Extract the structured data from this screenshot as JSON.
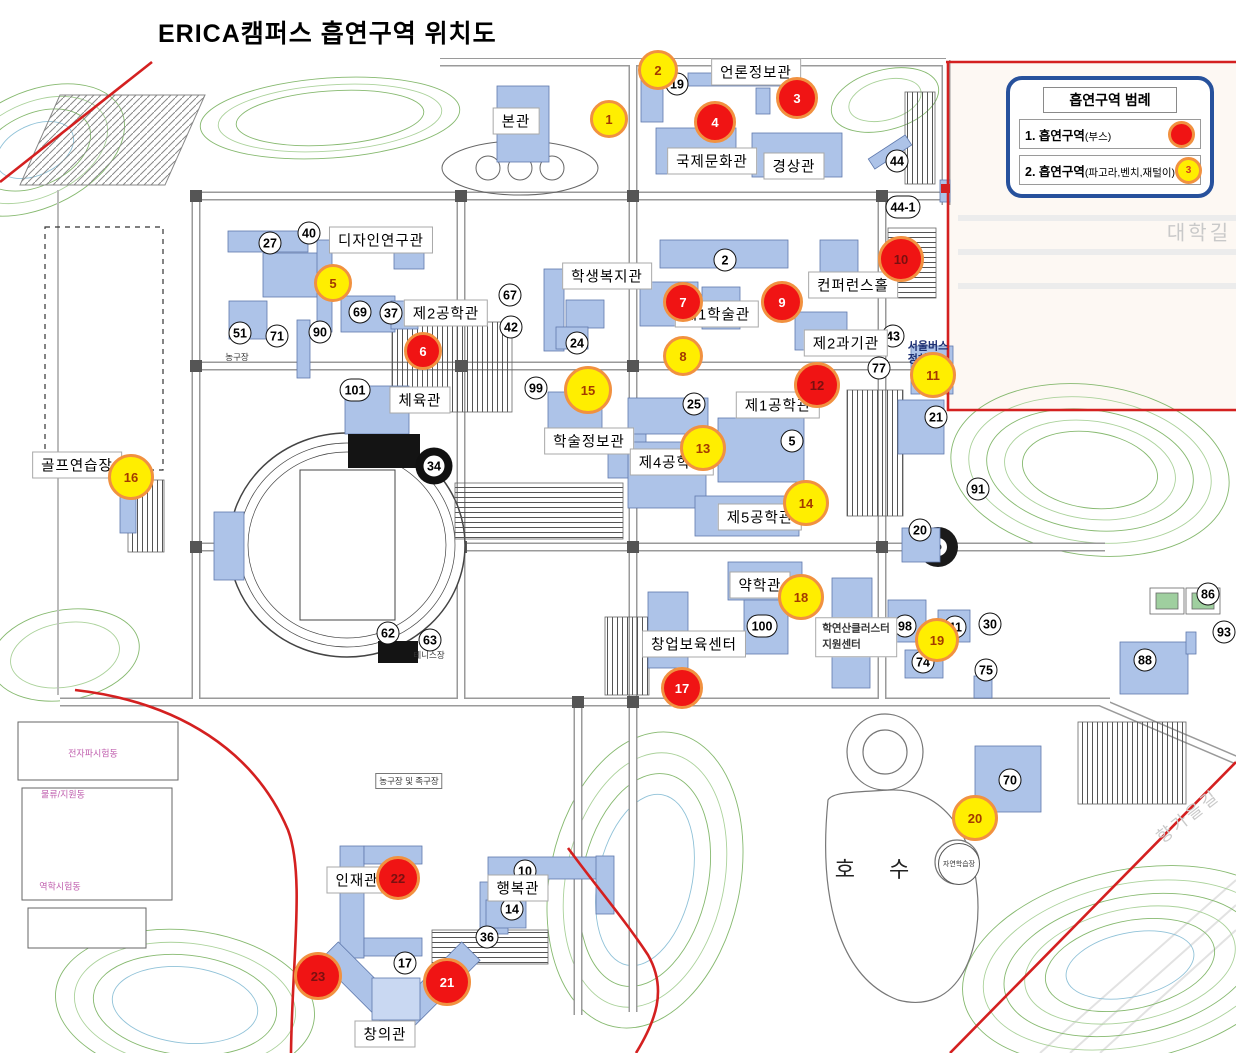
{
  "title": "ERICA캠퍼스 흡연구역 위치도",
  "legend": {
    "title": "흡연구역 범례",
    "items": [
      {
        "prefix": "1. 흡연구역",
        "paren": "(부스)",
        "type": "red",
        "sample": ""
      },
      {
        "prefix": "2. 흡연구역",
        "paren": "(파고라,벤치,재털이)",
        "type": "yellow",
        "sample": "3"
      }
    ]
  },
  "colors": {
    "booth_marker": "#f01414",
    "bench_marker": "#ffee00",
    "marker_ring": "#f19140",
    "legend_border": "#27519c",
    "building_fill": "#adc3e8",
    "boundary_line": "#d42020"
  },
  "markers": [
    {
      "n": "1",
      "type": "yellow",
      "x": 609,
      "y": 119,
      "d": 38
    },
    {
      "n": "2",
      "type": "yellow",
      "x": 658,
      "y": 70,
      "d": 40
    },
    {
      "n": "3",
      "type": "red",
      "x": 797,
      "y": 98,
      "d": 42
    },
    {
      "n": "4",
      "type": "red",
      "x": 715,
      "y": 122,
      "d": 42
    },
    {
      "n": "5",
      "type": "yellow",
      "x": 333,
      "y": 283,
      "d": 38
    },
    {
      "n": "6",
      "type": "red",
      "x": 423,
      "y": 351,
      "d": 38
    },
    {
      "n": "7",
      "type": "red",
      "x": 683,
      "y": 302,
      "d": 40
    },
    {
      "n": "8",
      "type": "yellow",
      "x": 683,
      "y": 356,
      "d": 40
    },
    {
      "n": "9",
      "type": "red",
      "x": 782,
      "y": 302,
      "d": 42
    },
    {
      "n": "10",
      "type": "red",
      "x": 901,
      "y": 259,
      "d": 46,
      "dark": true
    },
    {
      "n": "11",
      "type": "yellow",
      "x": 933,
      "y": 375,
      "d": 46
    },
    {
      "n": "12",
      "type": "red",
      "x": 817,
      "y": 385,
      "d": 46,
      "dark": true
    },
    {
      "n": "13",
      "type": "yellow",
      "x": 703,
      "y": 448,
      "d": 46
    },
    {
      "n": "14",
      "type": "yellow",
      "x": 806,
      "y": 503,
      "d": 46
    },
    {
      "n": "15",
      "type": "yellow",
      "x": 588,
      "y": 390,
      "d": 48
    },
    {
      "n": "16",
      "type": "yellow",
      "x": 131,
      "y": 477,
      "d": 46
    },
    {
      "n": "17",
      "type": "red",
      "x": 682,
      "y": 688,
      "d": 42
    },
    {
      "n": "18",
      "type": "yellow",
      "x": 801,
      "y": 597,
      "d": 46
    },
    {
      "n": "19",
      "type": "yellow",
      "x": 937,
      "y": 640,
      "d": 44
    },
    {
      "n": "20",
      "type": "yellow",
      "x": 975,
      "y": 818,
      "d": 46
    },
    {
      "n": "21",
      "type": "red",
      "x": 447,
      "y": 982,
      "d": 48
    },
    {
      "n": "22",
      "type": "red",
      "x": 398,
      "y": 878,
      "d": 44,
      "dark": true
    },
    {
      "n": "23",
      "type": "red",
      "x": 318,
      "y": 976,
      "d": 48,
      "dark": true
    }
  ],
  "building_labels": [
    {
      "text": "본관",
      "x": 516,
      "y": 121
    },
    {
      "text": "언론정보관",
      "x": 756,
      "y": 72
    },
    {
      "text": "국제문화관",
      "x": 712,
      "y": 161
    },
    {
      "text": "경상관",
      "x": 794,
      "y": 166
    },
    {
      "text": "디자인연구관",
      "x": 381,
      "y": 240
    },
    {
      "text": "제2공학관",
      "x": 446,
      "y": 313
    },
    {
      "text": "학생복지관",
      "x": 607,
      "y": 276
    },
    {
      "text": "제1학술관",
      "x": 717,
      "y": 314
    },
    {
      "text": "컨퍼런스홀",
      "x": 853,
      "y": 285
    },
    {
      "text": "제2과기관",
      "x": 846,
      "y": 343
    },
    {
      "text": "체육관",
      "x": 420,
      "y": 400
    },
    {
      "text": "학술정보관",
      "x": 589,
      "y": 441
    },
    {
      "text": "제1공학관",
      "x": 778,
      "y": 405
    },
    {
      "text": "제4공학관",
      "x": 672,
      "y": 462
    },
    {
      "text": "제5공학관",
      "x": 760,
      "y": 517
    },
    {
      "text": "골프연습장",
      "x": 77,
      "y": 465
    },
    {
      "text": "약학관",
      "x": 760,
      "y": 585
    },
    {
      "text": "창업보육센터",
      "x": 694,
      "y": 644
    },
    {
      "text": "인재관",
      "x": 357,
      "y": 880
    },
    {
      "text": "행복관",
      "x": 518,
      "y": 888
    },
    {
      "text": "창의관",
      "x": 385,
      "y": 1034
    }
  ],
  "building_numbers": [
    {
      "n": "19",
      "x": 677,
      "y": 84
    },
    {
      "n": "44",
      "x": 897,
      "y": 161
    },
    {
      "n": "44-1",
      "x": 903,
      "y": 207,
      "wide": true
    },
    {
      "n": "27",
      "x": 270,
      "y": 243
    },
    {
      "n": "40",
      "x": 309,
      "y": 233
    },
    {
      "n": "67",
      "x": 510,
      "y": 295
    },
    {
      "n": "42",
      "x": 511,
      "y": 327
    },
    {
      "n": "69",
      "x": 360,
      "y": 312
    },
    {
      "n": "37",
      "x": 391,
      "y": 313
    },
    {
      "n": "51",
      "x": 240,
      "y": 333
    },
    {
      "n": "71",
      "x": 277,
      "y": 336
    },
    {
      "n": "90",
      "x": 320,
      "y": 332
    },
    {
      "n": "24",
      "x": 577,
      "y": 343
    },
    {
      "n": "2",
      "x": 725,
      "y": 260
    },
    {
      "n": "43",
      "x": 893,
      "y": 336
    },
    {
      "n": "77",
      "x": 879,
      "y": 368
    },
    {
      "n": "101",
      "x": 355,
      "y": 390,
      "wide": true
    },
    {
      "n": "99",
      "x": 536,
      "y": 388
    },
    {
      "n": "34",
      "x": 434,
      "y": 466,
      "black": true
    },
    {
      "n": "25",
      "x": 694,
      "y": 404
    },
    {
      "n": "5",
      "x": 792,
      "y": 441
    },
    {
      "n": "21",
      "x": 936,
      "y": 417
    },
    {
      "n": "91",
      "x": 978,
      "y": 489
    },
    {
      "n": "20",
      "x": 920,
      "y": 530
    },
    {
      "n": "62",
      "x": 388,
      "y": 633
    },
    {
      "n": "63",
      "x": 430,
      "y": 640
    },
    {
      "n": "100",
      "x": 762,
      "y": 626,
      "wide": true
    },
    {
      "n": "98",
      "x": 905,
      "y": 626
    },
    {
      "n": "41",
      "x": 955,
      "y": 627
    },
    {
      "n": "30",
      "x": 990,
      "y": 624
    },
    {
      "n": "74",
      "x": 923,
      "y": 662
    },
    {
      "n": "75",
      "x": 986,
      "y": 670
    },
    {
      "n": "86",
      "x": 1208,
      "y": 594
    },
    {
      "n": "93",
      "x": 1224,
      "y": 632
    },
    {
      "n": "88",
      "x": 1145,
      "y": 660
    },
    {
      "n": "70",
      "x": 1010,
      "y": 780
    },
    {
      "n": "10",
      "x": 525,
      "y": 871
    },
    {
      "n": "14",
      "x": 512,
      "y": 909
    },
    {
      "n": "36",
      "x": 487,
      "y": 937
    },
    {
      "n": "17",
      "x": 405,
      "y": 963
    }
  ],
  "area_labels": [
    {
      "text": "농구장",
      "x": 237,
      "y": 357,
      "cls": "tiny"
    },
    {
      "text": "테니스장",
      "x": 429,
      "y": 655,
      "cls": "tiny"
    },
    {
      "text": "농구장 및 족구장",
      "x": 409,
      "y": 781,
      "cls": "tinybox"
    },
    {
      "text": "자연학습장",
      "x": 959,
      "y": 864,
      "cls": "circle"
    },
    {
      "text": "전자파시험동",
      "x": 93,
      "y": 753,
      "cls": "pink"
    },
    {
      "text": "물류/지원동",
      "x": 63,
      "y": 794,
      "cls": "pink"
    },
    {
      "text": "역학시험동",
      "x": 60,
      "y": 886,
      "cls": "pink"
    },
    {
      "text": "호 수",
      "x": 879,
      "y": 868,
      "cls": "lake"
    },
    {
      "text": "대학길",
      "x": 1199,
      "y": 231,
      "cls": "roadname"
    },
    {
      "text": "향가을길",
      "x": 1187,
      "y": 815,
      "cls": "roadname rot"
    },
    {
      "text": "서울버스\n정차장",
      "x": 928,
      "y": 353,
      "cls": "busstop"
    },
    {
      "text": "학연산클러스터\n지원센터",
      "x": 856,
      "y": 637,
      "cls": "cluster"
    }
  ]
}
